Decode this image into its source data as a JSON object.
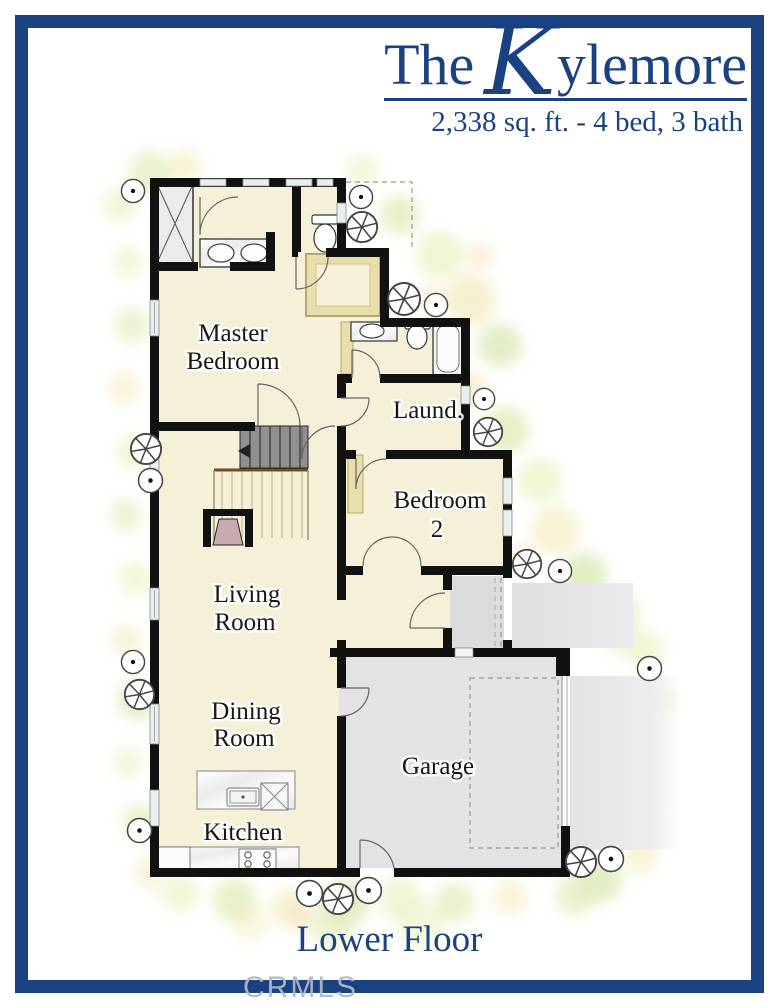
{
  "header": {
    "title_the": "The",
    "title_k": "K",
    "title_rest": "ylemore",
    "subtitle": "2,338 sq. ft. - 4 bed, 3 bath"
  },
  "rooms": {
    "master": [
      "Master",
      "Bedroom"
    ],
    "laundry": [
      "Laund."
    ],
    "bedroom2": [
      "Bedroom",
      "2"
    ],
    "living": [
      "Living",
      "Room"
    ],
    "dining": [
      "Dining",
      "Room"
    ],
    "kitchen": [
      "Kitchen"
    ],
    "garage": [
      "Garage"
    ]
  },
  "footer": {
    "floor_label": "Lower Floor",
    "watermark": "CRMLS"
  },
  "colors": {
    "navy": "#1a4283",
    "floor_cream": "#f5f1d9",
    "closet_tan": "#e9dfad",
    "garage_gray": "#e3e3e5",
    "wall_black": "#111111",
    "fireplace_mauve": "#c9a9b0"
  }
}
